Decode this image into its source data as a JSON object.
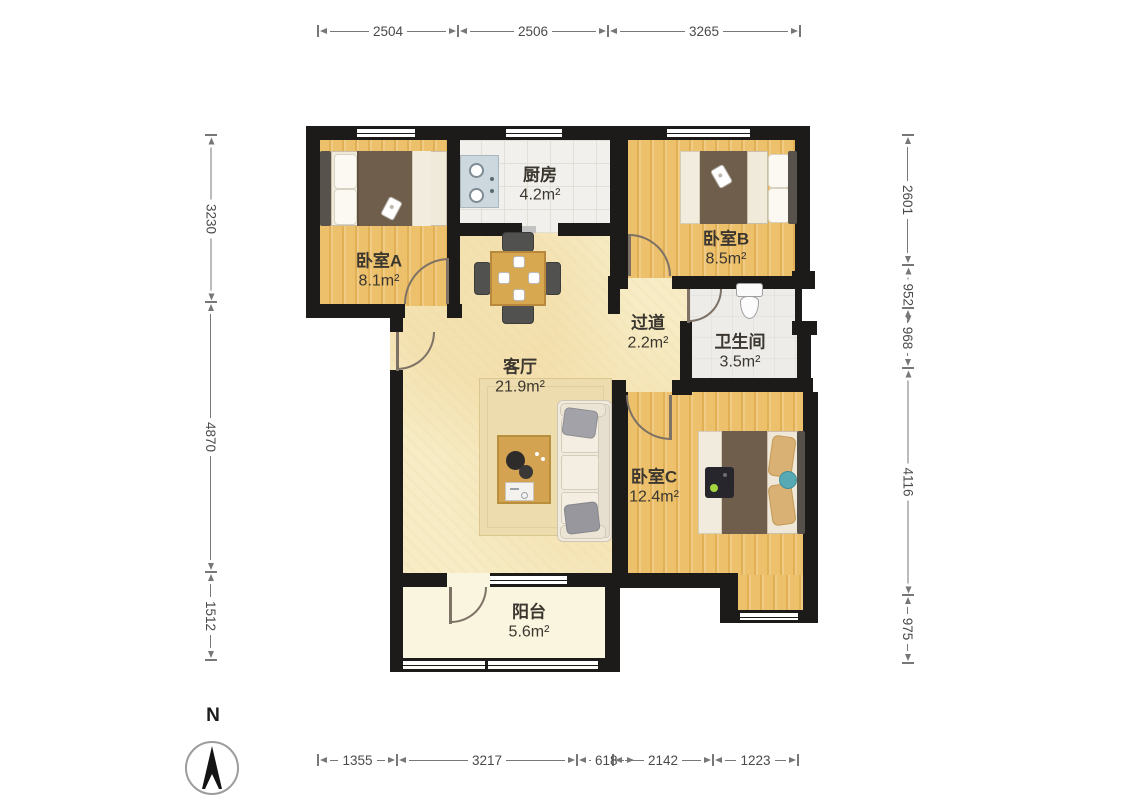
{
  "compass": {
    "label": "N"
  },
  "rooms": {
    "kitchen": {
      "name": "厨房",
      "area": "4.2m²"
    },
    "bedroomA": {
      "name": "卧室A",
      "area": "8.1m²"
    },
    "bedroomB": {
      "name": "卧室B",
      "area": "8.5m²"
    },
    "hallway": {
      "name": "过道",
      "area": "2.2m²"
    },
    "bathroom": {
      "name": "卫生间",
      "area": "3.5m²"
    },
    "living": {
      "name": "客厅",
      "area": "21.9m²"
    },
    "bedroomC": {
      "name": "卧室C",
      "area": "12.4m²"
    },
    "balcony": {
      "name": "阳台",
      "area": "5.6m²"
    }
  },
  "dimensions": {
    "top": [
      "2504",
      "2506",
      "3265"
    ],
    "left": [
      "3230",
      "4870",
      "1512"
    ],
    "right": [
      "2601",
      "952",
      "968",
      "4116",
      "975"
    ],
    "bottom": [
      "1355",
      "3217",
      "618",
      "2142",
      "1223"
    ]
  },
  "colors": {
    "wall": "#1d1b19",
    "wood_floor": "#eabc66",
    "living_floor": "#f7ecc5",
    "kitchen_floor": "#f1f0ec",
    "bathroom_floor": "#edece8",
    "balcony_floor": "#faf5df",
    "blanket_brown": "#6f5e4c",
    "teal_pillow": "#57a9b3",
    "dimension_text": "#4a4a4a"
  }
}
